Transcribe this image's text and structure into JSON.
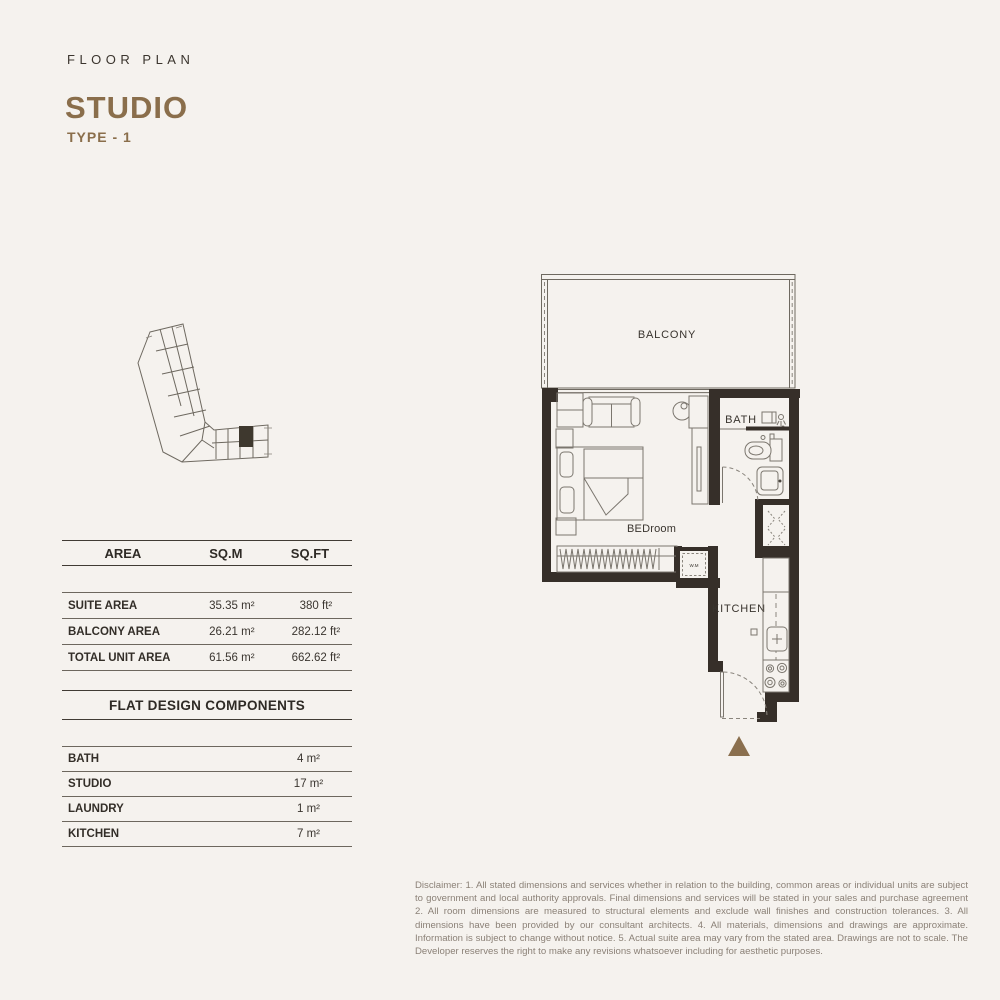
{
  "header": {
    "eyebrow": "FLOOR PLAN",
    "title": "STUDIO",
    "subtitle": "TYPE - 1"
  },
  "colors": {
    "accent_brown": "#8a6e4b",
    "wall": "#362f29",
    "background": "#f5f2ee",
    "table_line_dark": "#413b34",
    "table_line_light": "#6d675e",
    "disclaimer_text": "#8b8177"
  },
  "area_table": {
    "columns": [
      "AREA",
      "SQ.M",
      "SQ.FT"
    ],
    "rows": [
      {
        "label": "SUITE AREA",
        "sqm": "35.35 m²",
        "sqft": "380 ft²"
      },
      {
        "label": "BALCONY AREA",
        "sqm": "26.21 m²",
        "sqft": "282.12 ft²"
      },
      {
        "label": "TOTAL UNIT AREA",
        "sqm": "61.56 m²",
        "sqft": "662.62 ft²"
      }
    ]
  },
  "components_table": {
    "title": "FLAT DESIGN COMPONENTS",
    "rows": [
      {
        "label": "BATH",
        "value": "4 m²"
      },
      {
        "label": "STUDIO",
        "value": "17 m²"
      },
      {
        "label": "LAUNDRY",
        "value": "1 m²"
      },
      {
        "label": "KITCHEN",
        "value": "7 m²"
      }
    ]
  },
  "floor_plan": {
    "labels": {
      "balcony": "BALCONY",
      "bath": "BATH",
      "bedroom": "BEDroom",
      "kitchen": "KITCHEN",
      "washing_machine": "W.M"
    }
  },
  "disclaimer": "Disclaimer: 1. All stated dimensions and services whether in relation to the building, common areas or individual units are subject to government and local authority approvals. Final dimensions and services will be stated in your sales and purchase agreement 2. All room dimensions are measured to structural elements and exclude wall finishes and construction tolerances. 3. All dimensions have been provided by our consultant architects. 4. All materials, dimensions and drawings are approximate. Information is subject to change without notice. 5. Actual suite area may vary from the stated area. Drawings are not to scale. The Developer reserves the right to make any revisions whatsoever including for aesthetic purposes."
}
